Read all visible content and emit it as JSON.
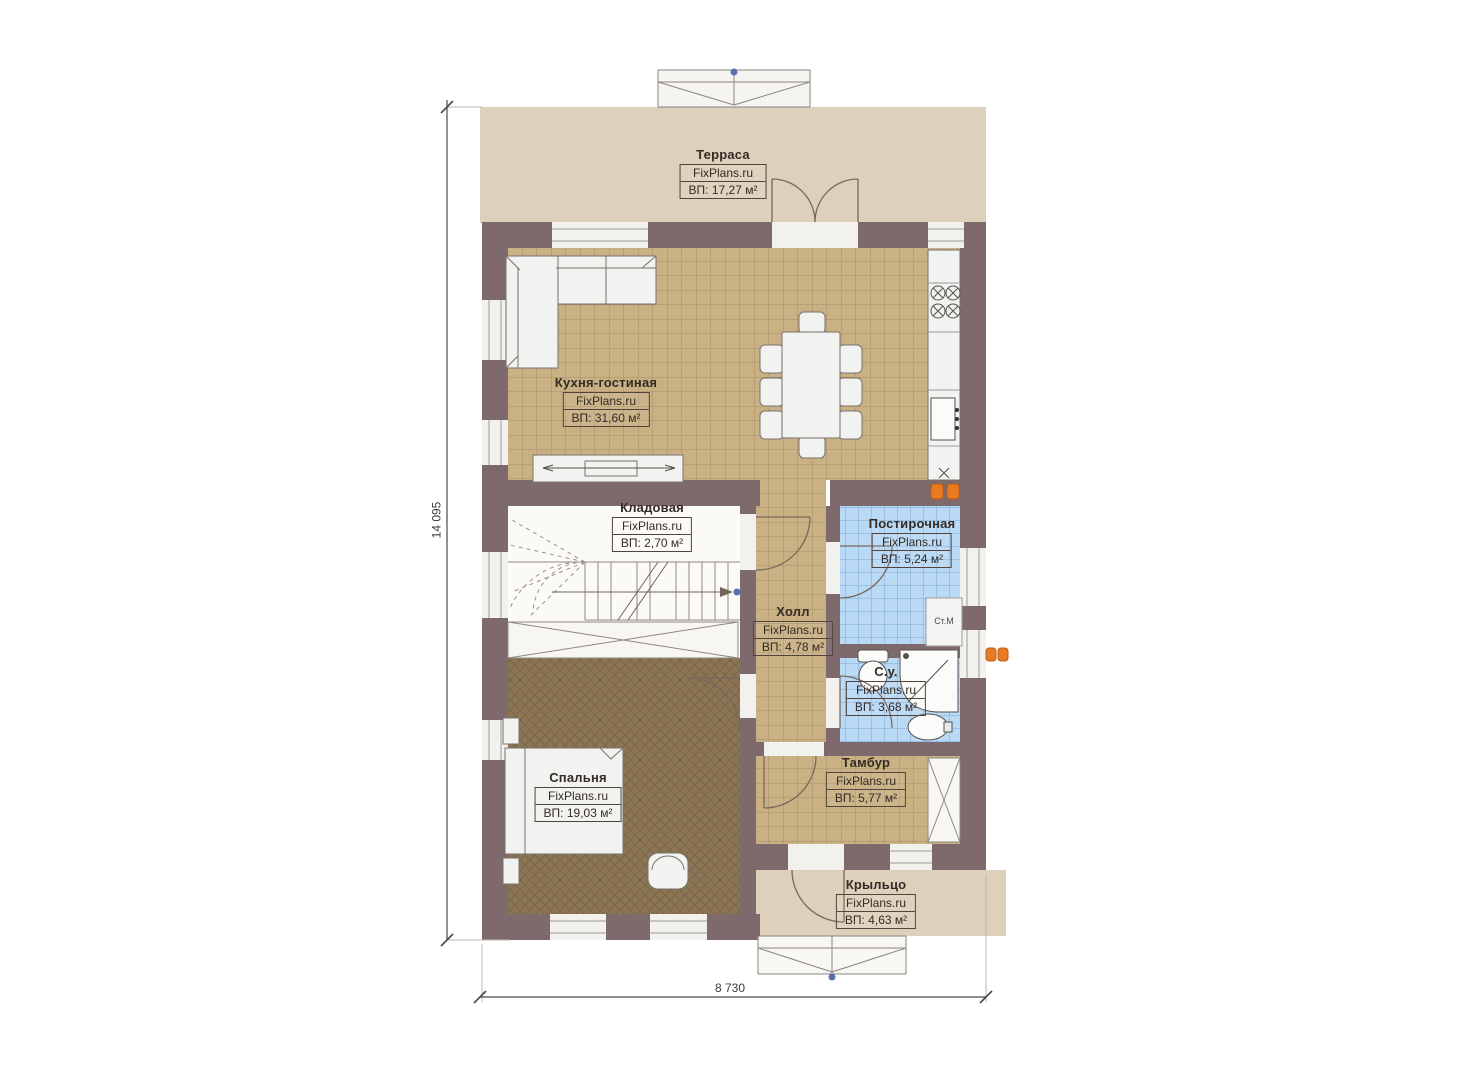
{
  "plan": {
    "site_watermark": "FixPlans.ru",
    "rooms": [
      {
        "name": "Терраса",
        "brand": "FixPlans.ru",
        "area": "ВП: 17,27 м²"
      },
      {
        "name": "Кухня-гостиная",
        "brand": "FixPlans.ru",
        "area": "ВП: 31,60 м²"
      },
      {
        "name": "Кладовая",
        "brand": "FixPlans.ru",
        "area": "ВП: 2,70 м²"
      },
      {
        "name": "Постирочная",
        "brand": "FixPlans.ru",
        "area": "ВП: 5,24 м²"
      },
      {
        "name": "Холл",
        "brand": "FixPlans.ru",
        "area": "ВП: 4,78 м²"
      },
      {
        "name": "С.у.",
        "brand": "FixPlans.ru",
        "area": "ВП: 3,68 м²"
      },
      {
        "name": "Спальня",
        "brand": "FixPlans.ru",
        "area": "ВП: 19,03 м²"
      },
      {
        "name": "Тамбур",
        "brand": "FixPlans.ru",
        "area": "ВП: 5,77 м²"
      },
      {
        "name": "Крыльцо",
        "brand": "FixPlans.ru",
        "area": "ВП: 4,63 м²"
      }
    ],
    "appliances": {
      "washing_machine": "Ст.М"
    },
    "dimensions": {
      "height_label": "14 095",
      "width_label": "8 730"
    },
    "colors": {
      "wall": "#7e6a6c",
      "terrace_floor": "#ddd1bc",
      "tile_floor": "#c9b183",
      "wet_floor": "#b9d9f4",
      "bedroom_floor": "#8c7555",
      "radiator": "#e87a22",
      "marker_dot": "#5b6fa8"
    }
  }
}
